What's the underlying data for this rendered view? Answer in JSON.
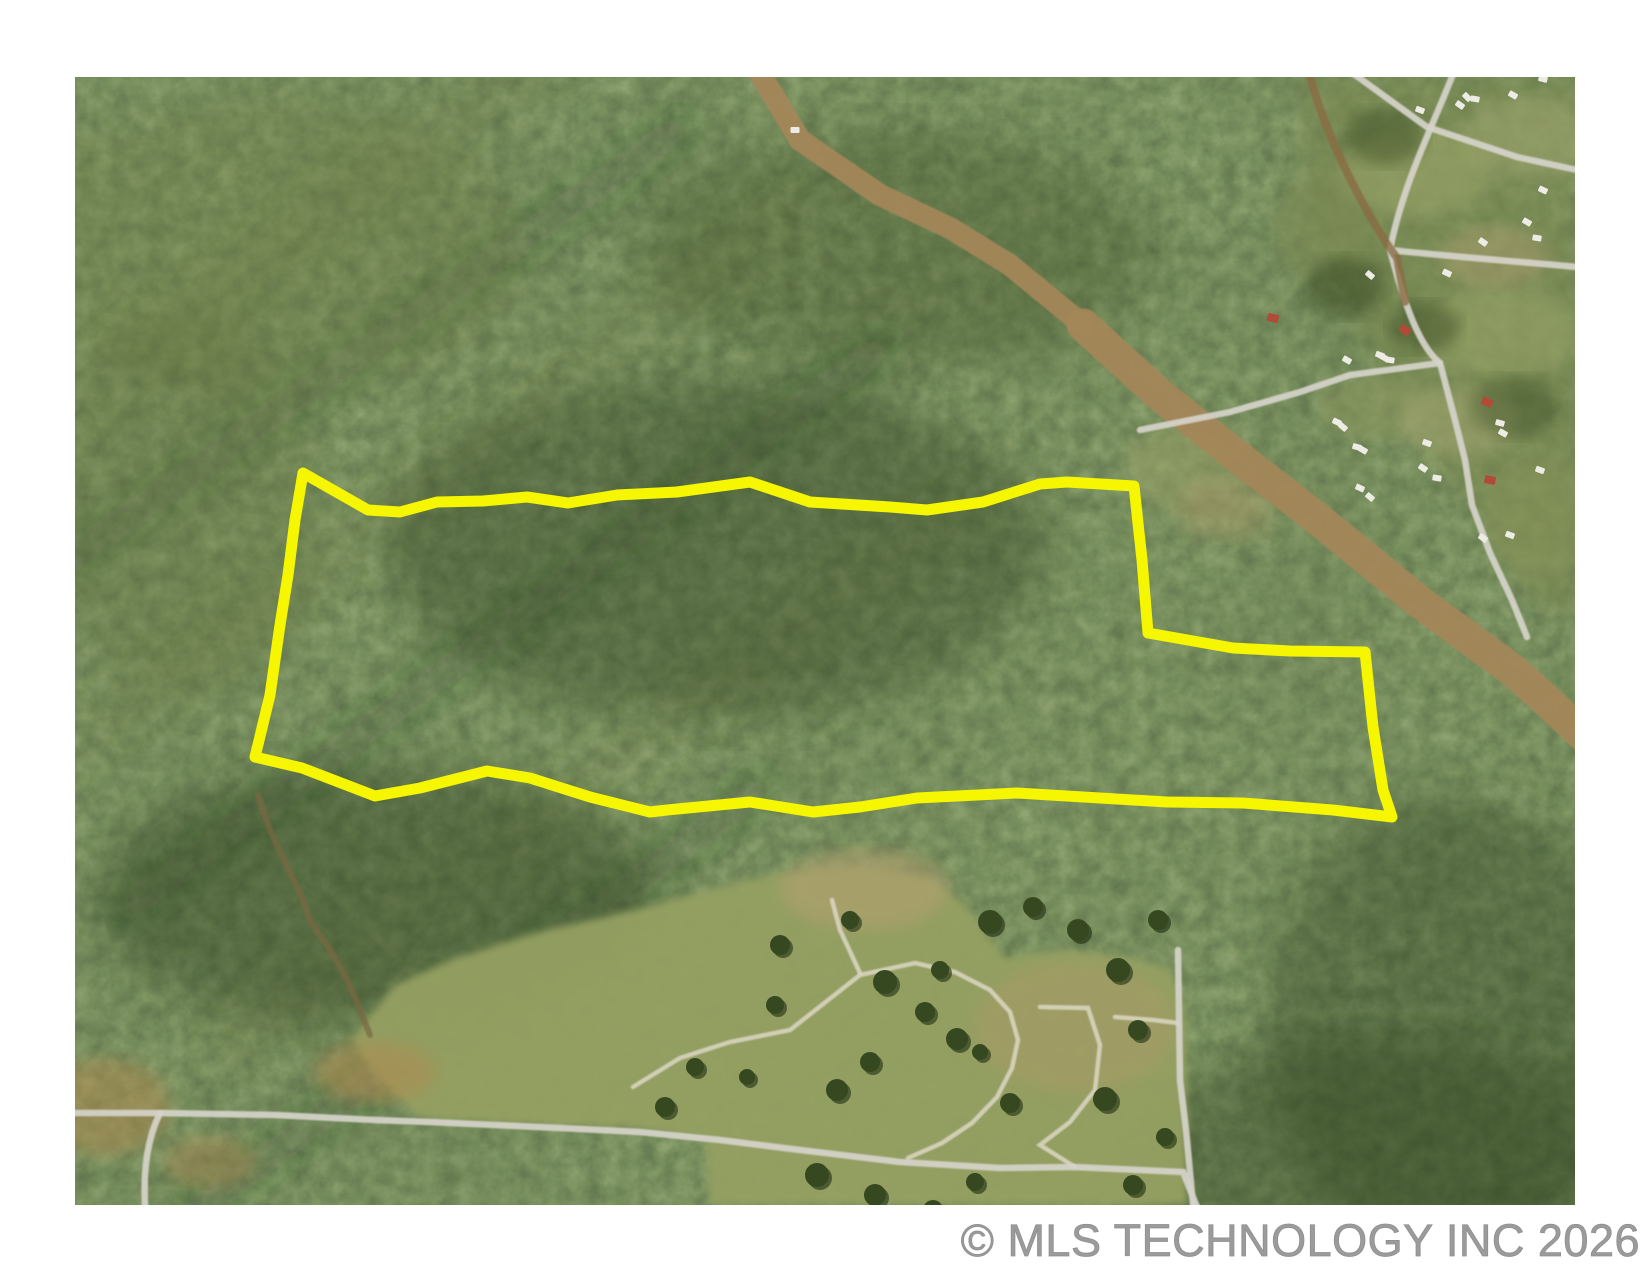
{
  "watermark": {
    "text": "© MLS TECHNOLOGY INC 2026"
  },
  "colors": {
    "background": "#ffffff",
    "boundary": "#f6f600",
    "road": "#d6d4cb",
    "trail": "#dcd7c3",
    "strip": "#a3875a",
    "dirt": "#8a6b42",
    "creek": "#7a6742",
    "pasture": "#95a062",
    "subdivision": "#7a8850",
    "tree": "#35481f",
    "house_white": "#edece4",
    "house_red": "#b14a36",
    "watermark": "#9b9b9b"
  },
  "photo": {
    "left": 75,
    "top": 77,
    "width": 1500,
    "height": 1128,
    "kind": "aerial-imagery-of-forested-parcel"
  },
  "parcel": {
    "outline_points": "228,396 293,433 325,435 362,425 408,424 452,420 493,426 542,418 602,415 675,405 735,425 815,430 852,433 908,425 965,407 992,405 1059,409 1067,483 1073,556 1158,571 1215,574 1290,575 1298,650 1308,713 1317,740 1258,733 1168,726 1092,725 1025,721 942,716 842,721 785,730 738,735 675,725 592,733 575,735 515,720 455,701 412,694 345,711 300,719 227,691 180,680 195,618 205,548 213,498 220,443"
  },
  "clearcut_strip": {
    "upper_d": "M680,-12 L725,63 L805,118 L875,151 L935,188 L1008,248",
    "lower_d": "M1008,248 L1085,318 L1158,376 L1248,446 L1342,523 L1440,595 L1522,670"
  },
  "subdivision": {
    "area_points": "1228,0 1505,0 1505,545 1455,520 1420,470 1390,420 1345,360 1310,300 1275,230 1245,140 1226,60"
  },
  "roads": {
    "bottom_road_d": "M-5,1036 L85,1036 L200,1038 L300,1043 L355,1045 L485,1051 L565,1055 L645,1063 L725,1073 L825,1085 L925,1091 L998,1090 L1108,1095 L1122,1130",
    "south_branch_d": "M85,1036 C73,1060 68,1090 70,1128",
    "right_lane_d": "M1103,873 L1105,1003 L1111,1053 L1115,1095 L1118,1128",
    "top_entry_d": "M1380,-8 C1360,45 1328,105 1315,173",
    "east_road_d": "M1315,173 C1380,180 1450,185 1502,190",
    "subdivision_road_d": "M1315,173 C1330,230 1345,270 1365,286 L1380,343 L1390,383 L1397,428 L1415,476 L1437,523 L1452,560",
    "corner_road_d": "M1272,-8 L1352,50 L1442,80 L1502,93",
    "cross_road_d": "M1065,353 L1155,335 L1225,315 L1275,298 L1365,286",
    "dirt_track_d": "M1233,-8 C1250,60 1292,140 1322,181 L1330,225"
  },
  "trails": {
    "s_curve_d": "M558,1010 L605,981 L655,965 L715,953 L785,898 L840,886 L880,895 L915,913 L935,935 L943,963 L937,991 L922,1020 L897,1046 L867,1066 L833,1081",
    "loop_d": "M965,930 L1013,931 L1025,968 L1020,1013 L995,1045 L965,1068 L1000,1090",
    "connector_d": "M1040,940 L1078,943 L1103,946",
    "spur_d": "M785,896 L765,853 L757,823"
  },
  "creek": {
    "d": "M183,718 L195,753 L210,785 L225,816 L235,843 L255,873 L275,908 L285,933 L295,958"
  },
  "pasture": {
    "area_points": "275,963 320,908 380,881 470,853 560,833 640,811 710,796 790,789 860,805 890,828 930,881 990,873 1050,880 1095,891 1110,933 1112,1128 635,1128 630,1063 565,1051 485,1048 405,1045 345,1041 305,1003"
  },
  "houses": [
    [
      1385,
      28,
      "w",
      35
    ],
    [
      1400,
      22,
      "w",
      10
    ],
    [
      1438,
      18,
      "w",
      30
    ],
    [
      1345,
      33,
      "w",
      20
    ],
    [
      1392,
      20,
      "w",
      45
    ],
    [
      1468,
      2,
      "w",
      15
    ],
    [
      1295,
      198,
      "w",
      40
    ],
    [
      1372,
      196,
      "w",
      25
    ],
    [
      1452,
      145,
      "w",
      30
    ],
    [
      1462,
      161,
      "w",
      10
    ],
    [
      1408,
      165,
      "w",
      35
    ],
    [
      1305,
      278,
      "w",
      20
    ],
    [
      1272,
      283,
      "w",
      30
    ],
    [
      720,
      53,
      "w",
      0
    ],
    [
      1468,
      113,
      "w",
      25
    ],
    [
      1465,
      393,
      "w",
      20
    ],
    [
      1308,
      280,
      "w",
      30
    ],
    [
      1315,
      283,
      "w",
      10
    ],
    [
      1262,
      345,
      "w",
      25
    ],
    [
      1268,
      350,
      "w",
      40
    ],
    [
      1282,
      370,
      "w",
      15
    ],
    [
      1288,
      373,
      "w",
      30
    ],
    [
      1352,
      366,
      "w",
      20
    ],
    [
      1348,
      391,
      "w",
      35
    ],
    [
      1362,
      401,
      "w",
      10
    ],
    [
      1285,
      411,
      "w",
      25
    ],
    [
      1295,
      420,
      "w",
      40
    ],
    [
      1425,
      346,
      "w",
      15
    ],
    [
      1428,
      356,
      "w",
      30
    ],
    [
      1435,
      458,
      "w",
      20
    ],
    [
      1408,
      461,
      "w",
      35
    ],
    [
      1330,
      253,
      "r",
      40
    ],
    [
      1198,
      241,
      "r",
      15
    ],
    [
      1412,
      325,
      "r",
      25
    ],
    [
      1415,
      403,
      "r",
      10
    ]
  ],
  "pasture_trees": [
    [
      810,
      905,
      12
    ],
    [
      850,
      935,
      10
    ],
    [
      882,
      962,
      11
    ],
    [
      795,
      985,
      10
    ],
    [
      762,
      1013,
      11
    ],
    [
      915,
      845,
      12
    ],
    [
      958,
      830,
      10
    ],
    [
      1003,
      853,
      11
    ],
    [
      1043,
      893,
      12
    ],
    [
      1063,
      953,
      10
    ],
    [
      1030,
      1022,
      12
    ],
    [
      935,
      1026,
      10
    ],
    [
      865,
      893,
      9
    ],
    [
      1083,
      843,
      10
    ],
    [
      775,
      843,
      9
    ],
    [
      705,
      868,
      10
    ],
    [
      742,
      1098,
      12
    ],
    [
      800,
      1118,
      11
    ],
    [
      858,
      1133,
      10
    ],
    [
      700,
      928,
      9
    ],
    [
      672,
      1000,
      8
    ],
    [
      905,
      975,
      8
    ],
    [
      1090,
      1060,
      9
    ],
    [
      1058,
      1108,
      10
    ],
    [
      620,
      990,
      9
    ],
    [
      590,
      1030,
      10
    ],
    [
      900,
      1105,
      9
    ]
  ]
}
